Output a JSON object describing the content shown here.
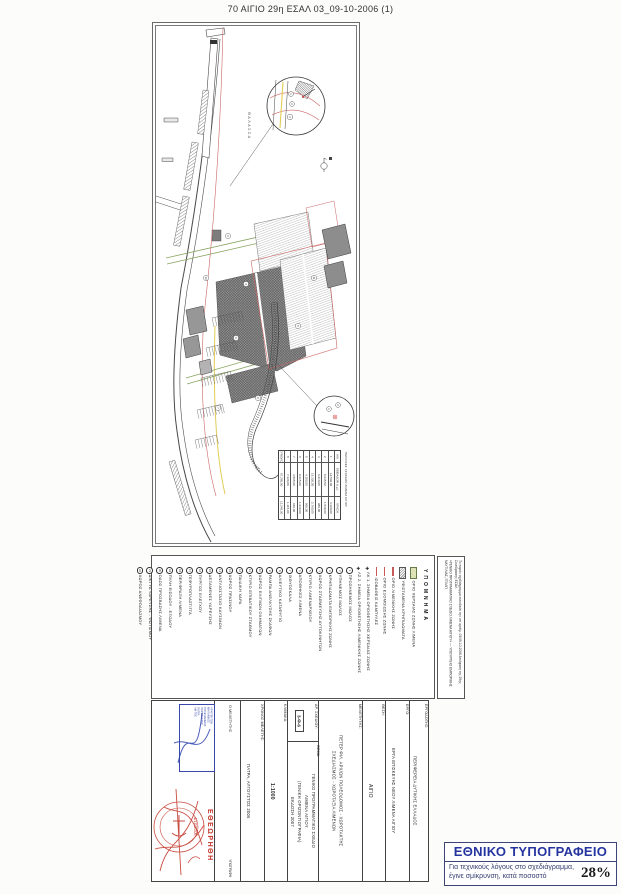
{
  "page": {
    "title": "70 ΑΙΓΙΟ 29η ΕΣΑΛ 03_09-10-2006 (1)"
  },
  "drawing": {
    "sea_label": "ΘΑΛΑΣΣΑ",
    "zone_refs": [
      "2",
      "3",
      "5",
      "6",
      "7",
      "9",
      "11",
      "13"
    ],
    "detail_a_refs": [
      "1",
      "2",
      "3"
    ],
    "detail_b_refs": [
      "1",
      "2"
    ],
    "area_table": {
      "header": "ΠΕΡΙΟΧΕΣ ΧΡΗΣΕΩΝ ΛΙΜΕΝΑ ΑΙΓΙΟΥ",
      "col_labels": [
        "Α/Α",
        "ΕΜΒΑΔΟΝ (τ.μ.)",
        "ΧΡΗΣΗ"
      ],
      "rows": [
        {
          "index": "1",
          "area": "12.540,00",
          "pct": "3.120,00"
        },
        {
          "index": "2",
          "area": "8.635,50",
          "pct": "1.540,00"
        },
        {
          "index": "3",
          "area": "6.210,00",
          "pct": "980,00"
        },
        {
          "index": "4",
          "area": "15.320,00",
          "pct": "2.760,00"
        },
        {
          "index": "5",
          "area": "4.180,00",
          "pct": "860,00"
        },
        {
          "index": "6",
          "area": "9.415,00",
          "pct": "1.230,00"
        },
        {
          "index": "7",
          "area": "3.865,00",
          "pct": "640,00"
        },
        {
          "index": "8",
          "area": "7.120,00",
          "pct": "1.115,00"
        }
      ],
      "total_label": "ΣΥΝΟΛΟ",
      "total_area": "67.285,50",
      "total_pct": "12.245,00"
    }
  },
  "legend": {
    "title": "ΥΠΟΜΝΗΜΑ",
    "swatches": [
      {
        "label": "ΟΡΙΟ ΧΕΡΣΑΙΑΣ ΖΩΝΗΣ ΛΙΜΕΝΑ"
      },
      {
        "label": "ΥΦΙΣΤΑΜΕΝΑ ΚΡΗΠΙΔΩΜΑΤΑ"
      },
      {
        "label": "ΟΡΙΟ ΛΙΜΕΝΙΚΗΣ ΖΩΝΗΣ"
      },
      {
        "label": "ΟΡΙΟ ΕΞΟΜΟΙΩΣΗΣ ΖΩΝΗΣ"
      },
      {
        "label": "ΙΣΟΒΑΘΕΙΣ ΚΑΜΠΥΛΕΣ"
      }
    ],
    "markers": [
      {
        "sym": "✚",
        "label": "ΛΚ 1. ΣΗΜΕΙΑ ΟΡΙΟΘΕΤΗΣΗΣ ΧΕΡΣΑΙΑΣ ΖΩΝΗΣ"
      },
      {
        "sym": "✚",
        "label": "ΛΣ 2. ΣΗΜΕΙΑ ΟΡΙΟΘΕΤΗΣΗΣ ΛΙΜΕΝΙΚΗΣ ΖΩΝΗΣ"
      }
    ],
    "items": [
      {
        "num": "1",
        "label": "ΠΡΟΣΗΝΕΜΟΣ ΜΩΛΟΣ"
      },
      {
        "num": "2",
        "label": "ΥΠΗΝΕΜΟΣ ΜΩΛΟΣ"
      },
      {
        "num": "3",
        "label": "ΚΡΗΠΙΔΩΜΑΤΑ ΕΜΠΟΡΙΚΗΣ ΖΩΝΗΣ"
      },
      {
        "num": "4",
        "label": "ΧΩΡΟΣ ΣΤΑΘΜΕΥΣΗΣ ΑΥΤΟΚΙΝΗΤΩΝ"
      },
      {
        "num": "5",
        "label": "ΚΤΙΡΙΟ ΛΙΜΕΝΑΡΧΕΙΟΥ"
      },
      {
        "num": "6",
        "label": "ΑΠΟΘΗΚΕΣ ΛΙΜΕΝΑ"
      },
      {
        "num": "7",
        "label": "ΙΧΘΥΟΣΚΑΛΑ"
      },
      {
        "num": "8",
        "label": "ΑΛΙΕΥΤΙΚΟ ΚΑΤΑΦΥΓΙΟ"
      },
      {
        "num": "9",
        "label": "ΡΑΜΠΑ ΑΝΕΛΚΥΣΗΣ ΣΚΑΦΩΝ"
      },
      {
        "num": "10",
        "label": "ΧΩΡΟΣ ΕΛΙΓΜΩΝ ΟΧΗΜΑΤΩΝ"
      },
      {
        "num": "11",
        "label": "ΚΤΙΡΙΟ ΕΠΙΒΑΤΙΚΟΥ ΣΤΑΘΜΟΥ"
      },
      {
        "num": "12",
        "label": "ΠΑΙΔΙΚΗ ΧΑΡΑ"
      },
      {
        "num": "13",
        "label": "ΧΩΡΟΣ ΠΡΑΣΙΝΟΥ"
      },
      {
        "num": "14",
        "label": "ΑΝΤΛΙΟΣΤΑΣΙΟ ΚΑΥΣΙΜΩΝ"
      },
      {
        "num": "15",
        "label": "ΔΕΞΑΜΕΝΕΣ ΥΔΡΕΥΣΗΣ"
      },
      {
        "num": "16",
        "label": "ΠΥΡΓΟΣ ΕΛΕΓΧΟΥ"
      },
      {
        "num": "17",
        "label": "ΓΕΦΥΡΟΠΛΑΣΤΙΓΓΑ"
      },
      {
        "num": "18",
        "label": "ΠΕΡΙΦΡΑΞΗ ΛΙΜΕΝΑ"
      },
      {
        "num": "19",
        "label": "ΠΥΛΗ ΕΙΣΟΔΟΥ - ΕΞΟΔΟΥ"
      },
      {
        "num": "20",
        "label": "ΟΔΟΣ ΠΡΟΣΒΑΣΗΣ ΛΙΜΕΝΑ"
      },
      {
        "num": "21",
        "label": "ΔΙΚΤΥΑ ΥΔΡΕΥΣΗΣ - ΦΩΤΙΣΜΟΥ"
      },
      {
        "num": "22",
        "label": "ΧΩΡΟΣ ΑΝΕΦΟΔΙΑΣΜΟΥ"
      }
    ]
  },
  "notes": {
    "lines": [
      "Το παρόν σχεδιάγραμμα συνοδεύει την υπ’ αριθμ. 03/09-10-2006 Απόφαση της 29ης Συνεδρίασης ΕΣΑΛ",
      "«ΓΕΝΙΚΟ ΠΡΟΓΡΑΜΜΑΤΙΚΟ ΣΧΕΔΙΟ ΛΙΜΕΝΑ ΑΙΓΙΟΥ» — ΥΠΟΥΡΓΕΙΟ ΕΜΠΟΡΙΚΗΣ ΝΑΥΤΙΛΙΑΣ, ΓΓΛΛΠ"
    ]
  },
  "title_block": {
    "employer_label": "ΕΡΓΟΔΟΤΗΣ:",
    "employer": "ΠΕΡΙΦΕΡΕΙΑ ΔΥΤΙΚΗΣ ΕΛΛΑΔΟΣ",
    "project_label": "ΕΡΓΟ:",
    "project": "ΕΡΓΑ ΕΠΙΣΚΕΥΗΣ ΝΕΟΥ ΛΙΜΕΝΑ ΑΙΓΙΟΥ",
    "location_label": "ΘΕΣΗ:",
    "location": "ΑΙΓΙΟ",
    "designer_label": "ΜΕΛΕΤΗΤΗΣ:",
    "designer_lines": [
      "ΠΕΤΕΡ ΦΙΛ. ΑΡΧ/ΩΝ ΠΟΛΕΟΔΟΜΟΣ - ΧΩΡΟΤΑΚΤΗΣ",
      "ΣΧΕΔΙΑΣΜΟΣ - ΧΩΡΟΤΑΞΙΑ ΛΙΜΕΝΩΝ"
    ],
    "drawing_no_label": "ΑΡ. ΣΧΕΔΙΟΥ:",
    "drawing_no": "3-Φ-6",
    "subject_label": "ΘΕΜΑ:",
    "subject_lines": [
      "ΓΕΝΙΚΟ ΠΡΟΓΡΑΜΜΑΤΙΚΟ ΣΧΕΔΙΟ",
      "ΛΙΜΕΝΑ ΑΙΓΙΟΥ",
      "(ΓΕΝΙΚΗ ΟΡΙΖΟΝΤΙΟΓΡΑΦΙΑ)",
      "ΕΚΔΟΣΗ 2007"
    ],
    "scale_label": "ΚΛΙΜΑΚΑ:",
    "scale": "1:1000",
    "date_label": "ΧΡΟΝΟΣ ΜΕΛΕΤΗΣ:",
    "date": "ΠΑΤΡΑ, ΑΥΓΟΥΣΤΟΣ 2006",
    "signer_label": "Ο ΜΕΛΕΤΗΤΗΣ",
    "signature_label": "ΥΠΟΓΡΑΦΗ",
    "approved": "ΕΘΕΩΡΗΘΗ",
    "approved_date": "4/10/2006",
    "blue_stamp_lines": [
      "ΑΡΧΙΤΕΚΤΩΝ",
      "ΜΗΧΑΝΙΚΟΣ",
      "ΠΟΛΕΟΔΟΜΟΣ",
      "ΧΩΡΟΤΑΚΤΗΣ",
      "ΠΑΤΡΑ",
      "ΑΜ ΤΕΕ"
    ]
  },
  "printer_box": {
    "title": "ΕΘΝΙΚΟ ΤΥΠΟΓΡΑΦΕΙΟ",
    "note_line1": "Για τεχνικούς λόγους στο σχεδιάγραμμα,",
    "note_line2": "έγινε σμίκρυνση, κατά ποσοστό",
    "percent": "28%",
    "accent_color": "#2634a0"
  }
}
